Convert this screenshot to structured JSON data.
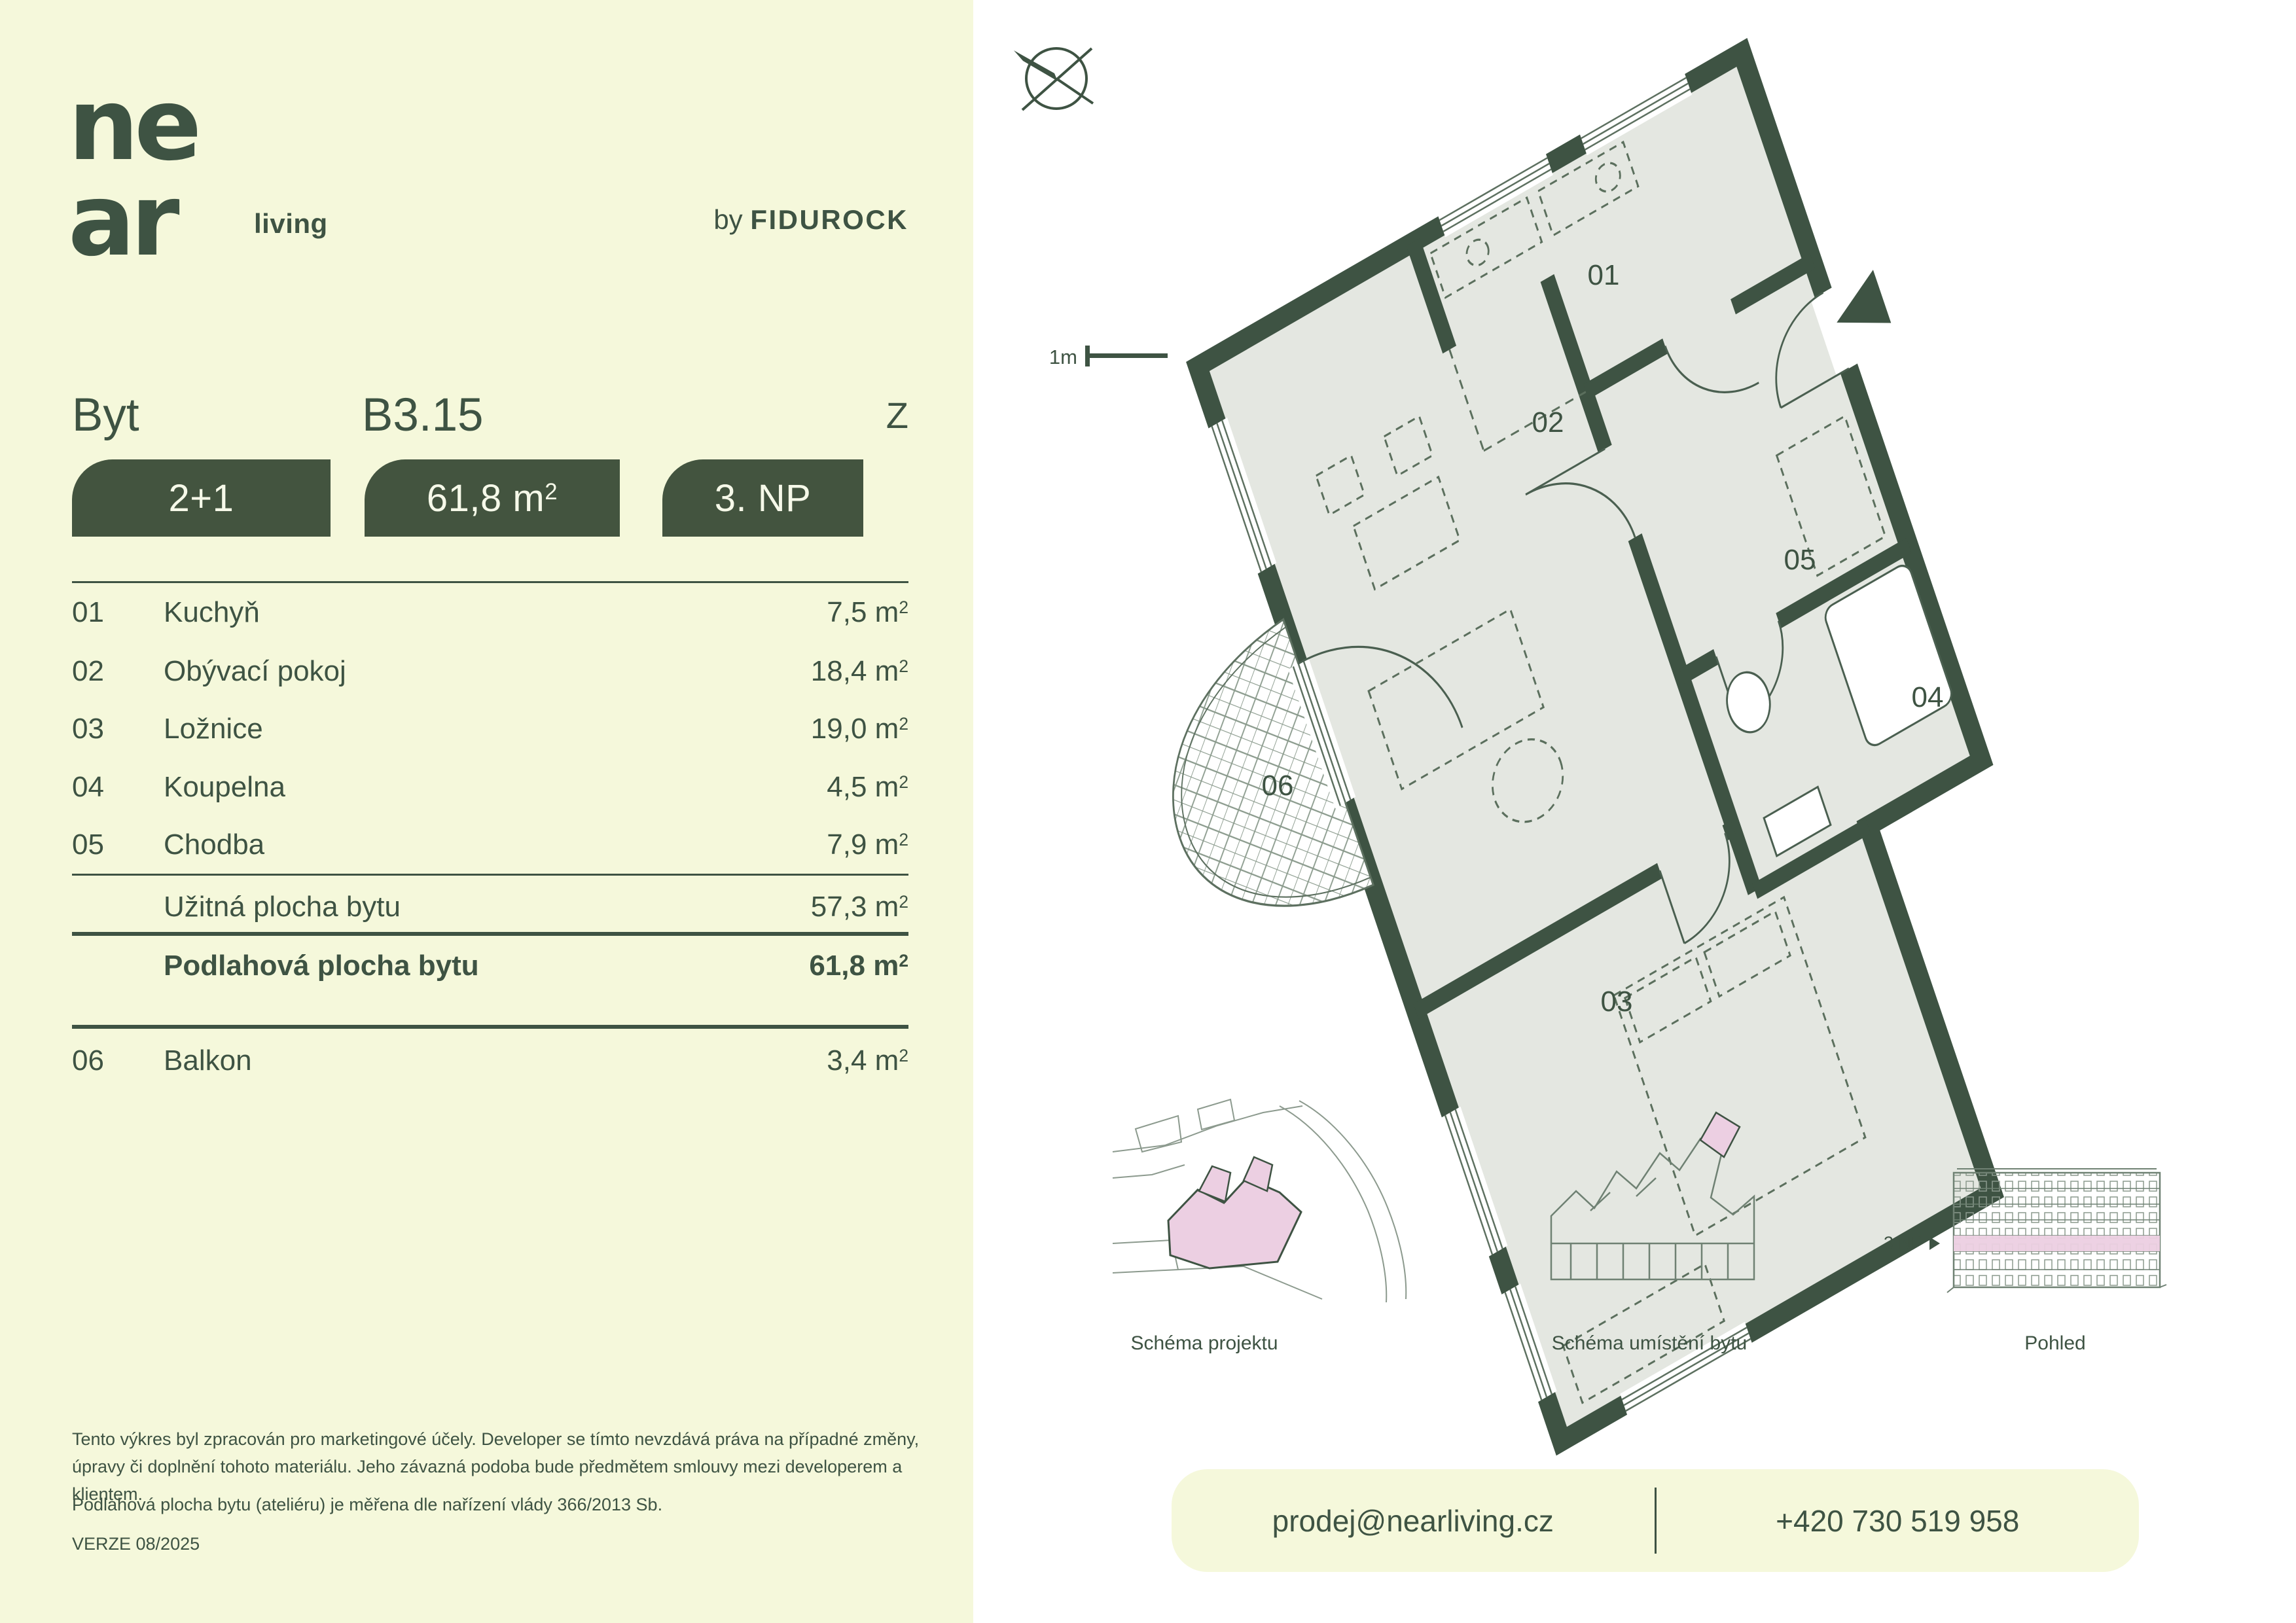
{
  "brand": {
    "logo_line1": "ne",
    "logo_line2": "ar",
    "logo_suffix": "living",
    "by_prefix": "by ",
    "by_name": "FIDUROCK"
  },
  "header": {
    "unit_label": "Byt",
    "unit_id": "B3.15",
    "orientation": "Z"
  },
  "badges": {
    "layout": "2+1",
    "area_value": "61,8",
    "floor": "3. NP"
  },
  "labels": {
    "unit_m": "m",
    "unit_sup": "2",
    "scale": "1m"
  },
  "rooms": [
    {
      "num": "01",
      "name": "Kuchyň",
      "area": "7,5"
    },
    {
      "num": "02",
      "name": "Obývací pokoj",
      "area": "18,4"
    },
    {
      "num": "03",
      "name": "Ložnice",
      "area": "19,0"
    },
    {
      "num": "04",
      "name": "Koupelna",
      "area": "4,5"
    },
    {
      "num": "05",
      "name": "Chodba",
      "area": "7,9"
    }
  ],
  "summary": {
    "usable_label": "Užitná plocha bytu",
    "usable_area": "57,3",
    "floor_label": "Podlahová plocha bytu",
    "floor_area": "61,8"
  },
  "balcony_row": {
    "num": "06",
    "name": "Balkon",
    "area": "3,4"
  },
  "plan": {
    "labels": [
      "01",
      "02",
      "03",
      "04",
      "05",
      "06"
    ]
  },
  "schematics": {
    "caption_project": "Schéma projektu",
    "caption_unit": "Schéma umístění bytu",
    "caption_view": "Pohled",
    "floor_marker": "3.NP"
  },
  "disclaimer": {
    "p1": "Tento výkres byl zpracován pro marketingové účely. Developer se tímto nevzdává práva na případné změny, úpravy či doplnění tohoto materiálu. Jeho závazná podoba bude předmětem smlouvy mezi developerem a klientem.",
    "p2": "Podlahová plocha bytu (ateliéru) je měřena dle nařízení vlády 366/2013 Sb.",
    "version": "VERZE 08/2025"
  },
  "contact": {
    "email": "prodej@nearliving.cz",
    "phone": "+420 730 519 958"
  },
  "colors": {
    "dark_green": "#3e5343",
    "cream": "#f5f8db",
    "plan_floor": "#e4e7e1",
    "pink": "#eccfe2"
  }
}
